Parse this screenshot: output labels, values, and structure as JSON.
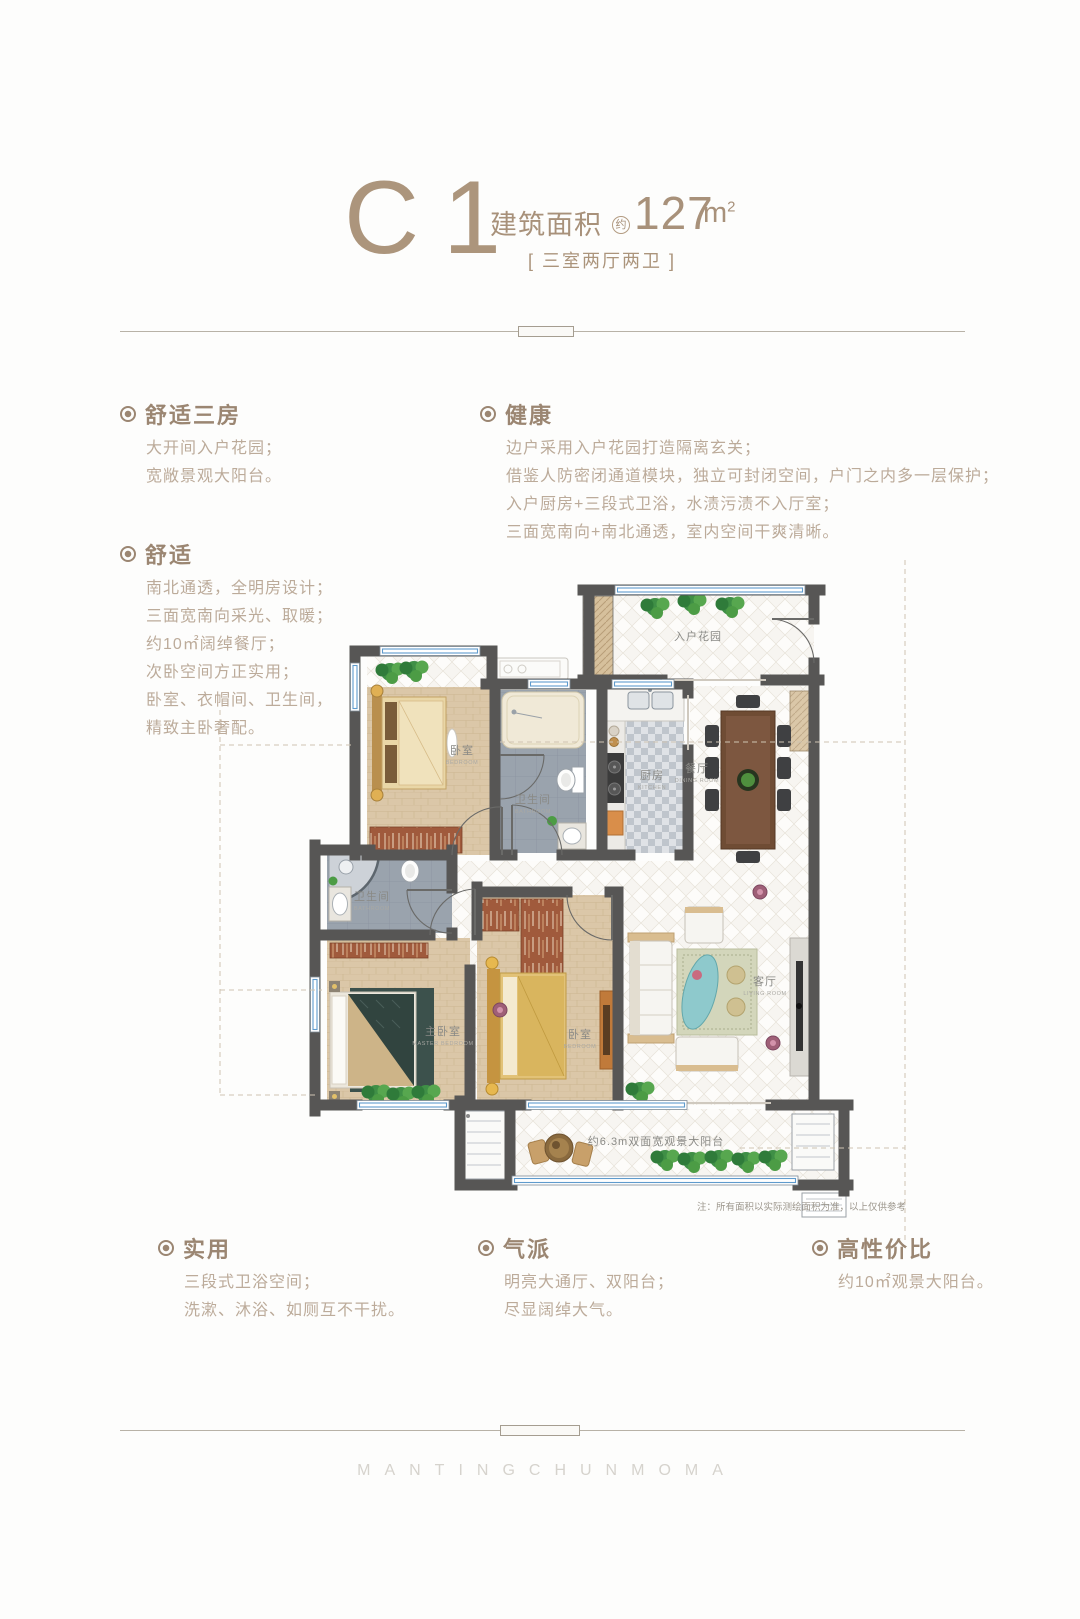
{
  "header": {
    "plan_code": "C1",
    "area_label": "建筑面积",
    "approx_mark": "约",
    "area_value": "127",
    "area_unit": "m",
    "area_exponent": "2",
    "layout_tag": "[ 三室两厅两卫 ]"
  },
  "features": {
    "comfort3": {
      "title": "舒适三房",
      "lines": [
        "大开间入户花园；",
        "宽敞景观大阳台。"
      ]
    },
    "health": {
      "title": "健康",
      "lines": [
        "边户采用入户花园打造隔离玄关；",
        "借鉴人防密闭通道模块，独立可封闭空间，户门之内多一层保护；",
        "入户厨房+三段式卫浴，水渍污渍不入厅室；",
        "三面宽南向+南北通透，室内空间干爽清晰。"
      ]
    },
    "comfort": {
      "title": "舒适",
      "lines": [
        "南北通透，全明房设计；",
        "三面宽南向采光、取暖；",
        "约10㎡阔绰餐厅；",
        "次卧空间方正实用；",
        "卧室、衣帽间、卫生间，",
        "精致主卧奢配。"
      ]
    },
    "practical": {
      "title": "实用",
      "lines": [
        "三段式卫浴空间；",
        "洗漱、沐浴、如厕互不干扰。"
      ]
    },
    "grand": {
      "title": "气派",
      "lines": [
        "明亮大通厅、双阳台；",
        "尽显阔绰大气。"
      ]
    },
    "value": {
      "title": "高性价比",
      "lines": [
        "约10㎡观景大阳台。"
      ]
    }
  },
  "floorplan": {
    "rooms": {
      "entry_garden": "入户花园",
      "bedroom_north": "卧室",
      "bedroom_north_en": "BEDROOM",
      "bathroom_north": "卫生间",
      "bathroom_north_en": "BATHROOM",
      "kitchen": "厨房",
      "kitchen_en": "KITCHEN",
      "dining": "餐厅",
      "dining_en": "DINING ROOM",
      "living": "客厅",
      "living_en": "LIVING ROOM",
      "bathroom_master": "卫生间",
      "bathroom_master_en": "BATHROOM",
      "master_bedroom": "主卧室",
      "master_bedroom_en": "MASTER BEDROOM",
      "bedroom_south": "卧室",
      "bedroom_south_en": "BEDROOM",
      "balcony": "约6.3m双面宽观景大阳台"
    },
    "note": "注：所有面积以实际测绘面积为准，以上仅供参考"
  },
  "watermark": "MANTINGCHUNMOMA",
  "colors": {
    "accent": "#9b8672",
    "body_text": "#bcab9a",
    "wall": "#575655",
    "window_blue": "#5f9bcd"
  }
}
